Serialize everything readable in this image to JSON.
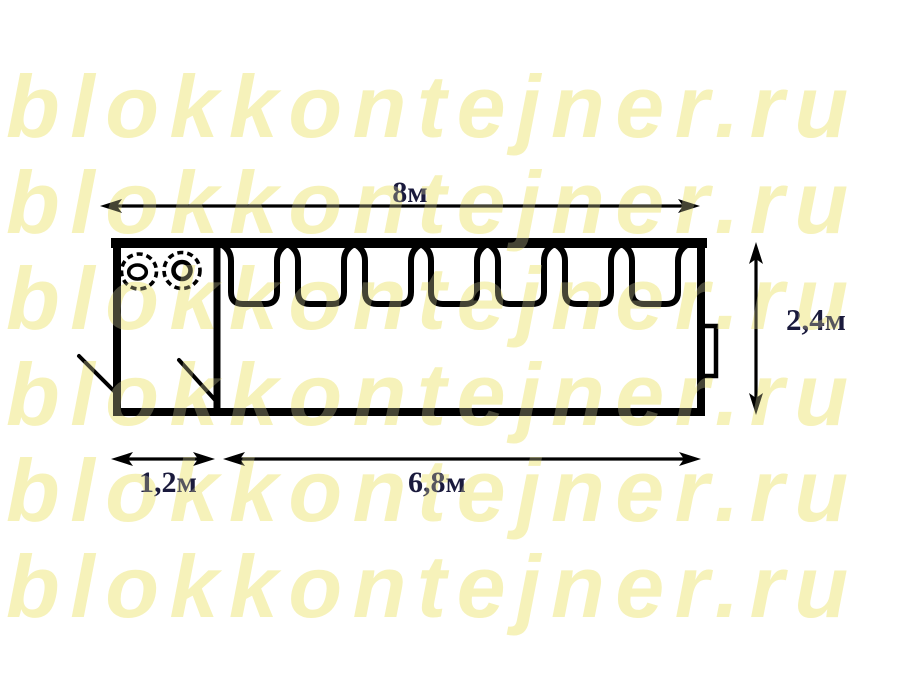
{
  "watermark": {
    "text": "blokkontejner.ru",
    "color": "#f6f2ba",
    "row_count": 6
  },
  "plan": {
    "line_color": "#000000",
    "label_color": "#1a1a3c",
    "labels": {
      "total_length": "8м",
      "height": "2,4м",
      "small_room": "1,2м",
      "large_room": "6,8м"
    },
    "window_count": 7,
    "stove_burner_count": 2
  }
}
